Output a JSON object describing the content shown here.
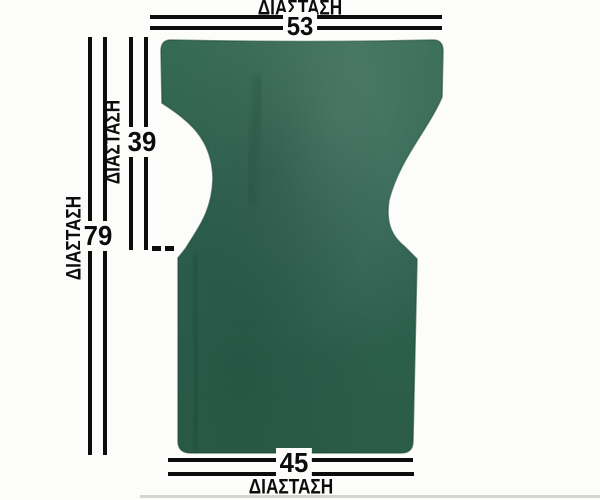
{
  "diagram": {
    "type": "product-dimension-diagram",
    "product": "director-chair-fabric-cover",
    "colors": {
      "fabric_base": "#2e6150",
      "fabric_light": "#3a6f5a",
      "fabric_dark": "#1f4c3b",
      "dimension_line": "#0c0c0c",
      "background": "#fcfcfa"
    },
    "dims": {
      "top": {
        "label": "ΔΙΑΣΤΑΣΗ",
        "value": "53"
      },
      "inner": {
        "label": "ΔΙΑΣΤΑΣΗ",
        "value": "39"
      },
      "outer": {
        "label": "ΔΙΑΣΤΑΣΗ",
        "value": "79"
      },
      "bottom": {
        "label": "ΔΙΑΣΤΑΣΗ",
        "value": "45"
      }
    }
  }
}
